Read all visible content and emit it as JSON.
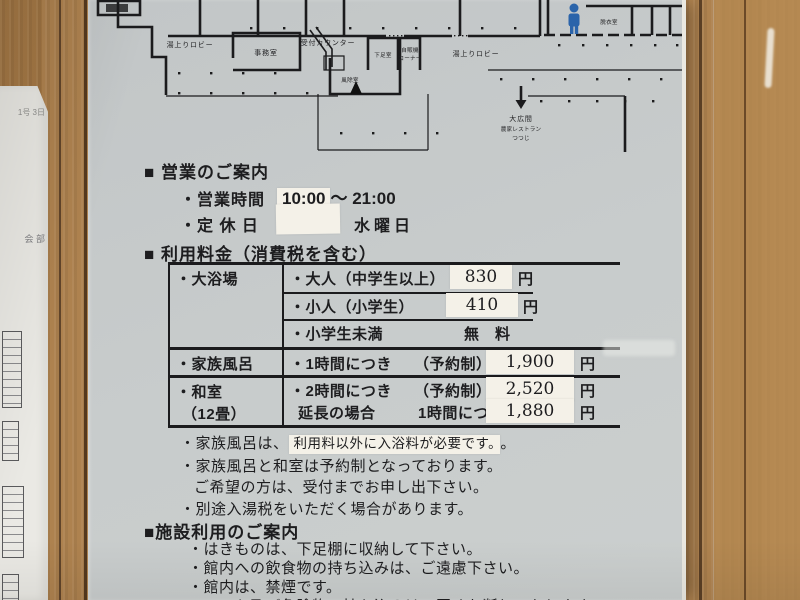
{
  "colors": {
    "sign_bg": "#c7cbcb",
    "sticker": "#f4f1e8",
    "wood": "#ab7d48",
    "ink": "#1d1d1f",
    "icon_blue": "#2b64aa"
  },
  "floorplan": {
    "labels": {
      "lobby_left": "湯上りロビー",
      "office": "事務室",
      "reception_counter": "受付カウンター",
      "shoe_room": "下足室",
      "vending_line1": "自販機",
      "vending_line2": "コーナー",
      "windbreak_room": "風除室",
      "lobby_right": "湯上りロビー",
      "top_right_room": "脱衣室",
      "arrow_line1": "大広間",
      "arrow_line2": "農家レストラン",
      "arrow_line3": "つつじ"
    }
  },
  "hours": {
    "title": "■ 営業のご案内",
    "time_label": "・営業時間",
    "time_patched": "10:00",
    "time_rest": "～ 21:00",
    "closed_label": "・定 休 日",
    "closed_value": "水曜日"
  },
  "fees": {
    "title": "■ 利用料金（消費税を含む）",
    "rows": {
      "bath_group": "・大浴場",
      "adult_item": "・大人（中学生以上）",
      "adult_price": "830",
      "child_item": "・小人（小学生）",
      "child_price": "410",
      "infant_item": "・小学生未満",
      "infant_price": "無　料",
      "family_group": "・家族風呂",
      "family_item": "・1時間につき",
      "family_note": "（予約制）",
      "family_price": "1,900",
      "washitsu_group": "・和室",
      "washitsu_group2": "（12畳）",
      "washitsu_item": "・2時間につき",
      "washitsu_note": "（予約制）",
      "washitsu_price": "2,520",
      "extension_item": "延長の場合",
      "extension_note": "1時間につき",
      "extension_price": "1,880",
      "yen": "円"
    },
    "notes": {
      "n1_pre": "・家族風呂は、",
      "n1_patch": "利用料以外に入浴料が必要です。",
      "n1_post": "。",
      "n2": "・家族風呂と和室は予約制となっております。",
      "n3": "ご希望の方は、受付までお申し出下さい。",
      "n4": "・別途入湯税をいただく場合があります。"
    }
  },
  "facility": {
    "title": "■施設利用のご案内",
    "items": [
      "・はきものは、下足棚に収納して下さい。",
      "・館内への飲食物の持ち込みは、ご遠慮下さい。",
      "・館内は、禁煙です。",
      "・ペット及び危険物の持ち込みは、固くお断りいたします。"
    ]
  },
  "left_paper": {
    "fragments": [
      "1号\n3日",
      "会\n部"
    ]
  }
}
